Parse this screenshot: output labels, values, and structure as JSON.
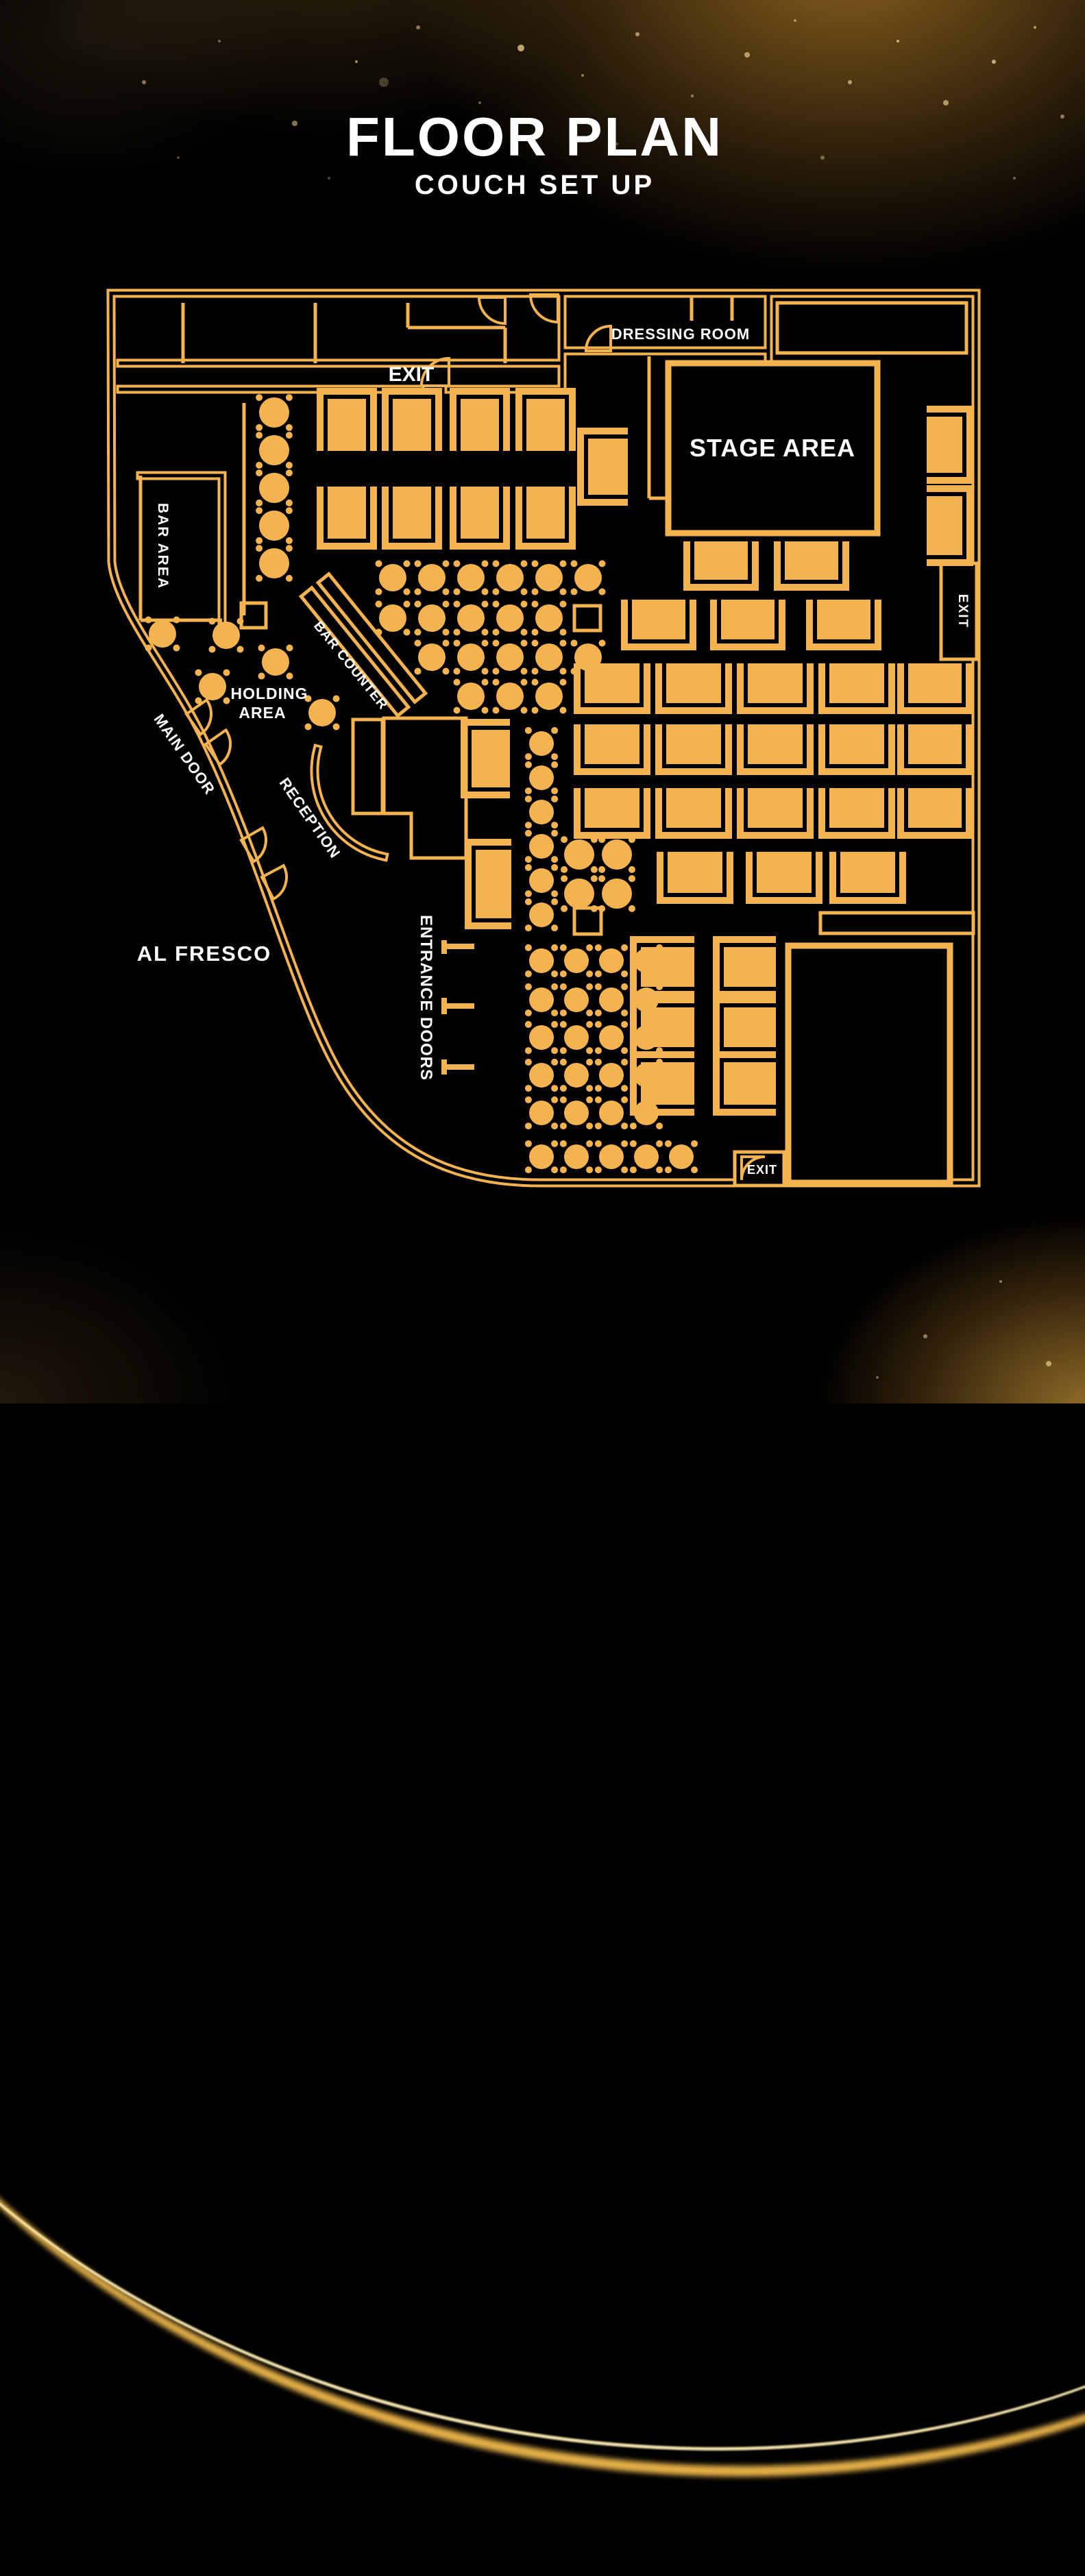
{
  "title": {
    "main": "FLOOR PLAN",
    "subtitle": "COUCH SET UP"
  },
  "colors": {
    "gold": "#F5B350",
    "background": "#000000",
    "text": "#FFFFFF"
  },
  "labels": {
    "exit_top": "EXIT",
    "exit_right": "EXIT",
    "exit_bottom": "EXIT",
    "dressing_room": "DRESSING ROOM",
    "stage_area": "STAGE AREA",
    "bar_area": "BAR AREA",
    "bar_counter": "BAR COUNTER",
    "holding_area_line1": "HOLDING",
    "holding_area_line2": "AREA",
    "main_door": "MAIN DOOR",
    "reception": "RECEPTION",
    "al_fresco": "AL FRESCO",
    "entrance_doors": "ENTRANCE DOORS"
  },
  "furniture": {
    "round_tables": [
      [
        400,
        602,
        22
      ],
      [
        400,
        657,
        22
      ],
      [
        400,
        712,
        22
      ],
      [
        400,
        767,
        22
      ],
      [
        400,
        822,
        22
      ],
      [
        573,
        843,
        20
      ],
      [
        630,
        843,
        20
      ],
      [
        687,
        843,
        20
      ],
      [
        744,
        843,
        20
      ],
      [
        801,
        843,
        20
      ],
      [
        858,
        843,
        20
      ],
      [
        573,
        902,
        20
      ],
      [
        630,
        902,
        20
      ],
      [
        687,
        902,
        20
      ],
      [
        744,
        902,
        20
      ],
      [
        801,
        902,
        20
      ],
      [
        630,
        959,
        20
      ],
      [
        687,
        959,
        20
      ],
      [
        744,
        959,
        20
      ],
      [
        801,
        959,
        20
      ],
      [
        858,
        959,
        20
      ],
      [
        687,
        1016,
        20
      ],
      [
        744,
        1016,
        20
      ],
      [
        801,
        1016,
        20
      ],
      [
        237,
        925,
        20
      ],
      [
        330,
        927,
        20
      ],
      [
        310,
        1002,
        20
      ],
      [
        402,
        966,
        20
      ],
      [
        470,
        1040,
        20
      ],
      [
        790,
        1085,
        18
      ],
      [
        790,
        1135,
        18
      ],
      [
        790,
        1185,
        18
      ],
      [
        790,
        1235,
        18
      ],
      [
        790,
        1285,
        18
      ],
      [
        790,
        1335,
        18
      ],
      [
        845,
        1247,
        22
      ],
      [
        900,
        1247,
        22
      ],
      [
        845,
        1304,
        22
      ],
      [
        900,
        1304,
        22
      ],
      [
        790,
        1402,
        18
      ],
      [
        841,
        1402,
        18
      ],
      [
        892,
        1402,
        18
      ],
      [
        943,
        1402,
        18
      ],
      [
        790,
        1459,
        18
      ],
      [
        841,
        1459,
        18
      ],
      [
        892,
        1459,
        18
      ],
      [
        943,
        1459,
        18
      ],
      [
        790,
        1514,
        18
      ],
      [
        841,
        1514,
        18
      ],
      [
        892,
        1514,
        18
      ],
      [
        943,
        1514,
        18
      ],
      [
        790,
        1569,
        18
      ],
      [
        841,
        1569,
        18
      ],
      [
        892,
        1569,
        18
      ],
      [
        943,
        1569,
        18
      ],
      [
        790,
        1624,
        18
      ],
      [
        841,
        1624,
        18
      ],
      [
        892,
        1624,
        18
      ],
      [
        943,
        1624,
        18
      ],
      [
        790,
        1688,
        18
      ],
      [
        841,
        1688,
        18
      ],
      [
        892,
        1688,
        18
      ],
      [
        943,
        1688,
        18
      ],
      [
        994,
        1688,
        18
      ]
    ],
    "square_tables": [
      [
        352,
        880,
        36,
        36
      ],
      [
        838,
        884,
        38,
        36
      ],
      [
        838,
        1325,
        39,
        38
      ]
    ],
    "couches": [
      [
        478,
        582,
        56,
        76,
        "down"
      ],
      [
        573,
        582,
        56,
        76,
        "down"
      ],
      [
        672,
        582,
        56,
        76,
        "down"
      ],
      [
        768,
        582,
        56,
        76,
        "down"
      ],
      [
        478,
        710,
        56,
        76,
        "up"
      ],
      [
        573,
        710,
        56,
        76,
        "up"
      ],
      [
        672,
        710,
        56,
        76,
        "up"
      ],
      [
        768,
        710,
        56,
        76,
        "up"
      ],
      [
        858,
        640,
        58,
        82,
        "right"
      ],
      [
        1352,
        608,
        52,
        82,
        "left"
      ],
      [
        1352,
        724,
        52,
        86,
        "left"
      ],
      [
        1013,
        790,
        78,
        56,
        "up"
      ],
      [
        1145,
        790,
        78,
        56,
        "up"
      ],
      [
        922,
        875,
        78,
        58,
        "up"
      ],
      [
        1052,
        875,
        78,
        58,
        "up"
      ],
      [
        1192,
        875,
        78,
        58,
        "up"
      ],
      [
        853,
        968,
        80,
        58,
        "up"
      ],
      [
        972,
        968,
        80,
        58,
        "up"
      ],
      [
        1091,
        968,
        80,
        58,
        "up"
      ],
      [
        1210,
        968,
        80,
        58,
        "up"
      ],
      [
        1325,
        968,
        78,
        58,
        "up"
      ],
      [
        853,
        1057,
        80,
        58,
        "up"
      ],
      [
        972,
        1057,
        80,
        58,
        "up"
      ],
      [
        1091,
        1057,
        80,
        58,
        "up"
      ],
      [
        1210,
        1057,
        80,
        58,
        "up"
      ],
      [
        1325,
        1057,
        78,
        58,
        "up"
      ],
      [
        853,
        1150,
        80,
        58,
        "up"
      ],
      [
        972,
        1150,
        80,
        58,
        "up"
      ],
      [
        1091,
        1150,
        80,
        58,
        "up"
      ],
      [
        1210,
        1150,
        80,
        58,
        "up"
      ],
      [
        1325,
        1150,
        78,
        58,
        "up"
      ],
      [
        974,
        1243,
        80,
        60,
        "up"
      ],
      [
        1104,
        1243,
        80,
        60,
        "up"
      ],
      [
        1226,
        1243,
        80,
        60,
        "up"
      ],
      [
        688,
        1065,
        56,
        84,
        "right"
      ],
      [
        694,
        1240,
        52,
        100,
        "right"
      ],
      [
        935,
        1382,
        78,
        58,
        "right"
      ],
      [
        935,
        1470,
        78,
        58,
        "right"
      ],
      [
        935,
        1550,
        78,
        62,
        "right"
      ],
      [
        1056,
        1382,
        76,
        58,
        "right"
      ],
      [
        1056,
        1470,
        76,
        58,
        "right"
      ],
      [
        1056,
        1550,
        76,
        62,
        "right"
      ]
    ]
  }
}
